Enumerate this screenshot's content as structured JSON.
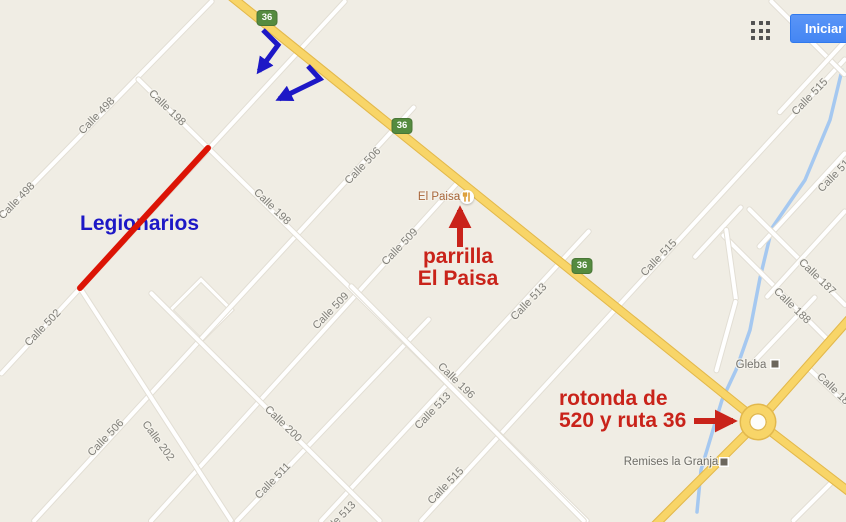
{
  "ui": {
    "signin_label": "Iniciar",
    "apps_icon": "grid-3x3-icon",
    "signin_color": "#4486f3"
  },
  "map": {
    "bg_color": "#f0ede4",
    "road_color": "#ffffff",
    "highway_color": "#f8d568",
    "river_color": "#a5c8f0",
    "label_color": "#807f79",
    "road_shields": [
      {
        "text": "36",
        "x": 267,
        "y": 18
      },
      {
        "text": "36",
        "x": 402,
        "y": 126
      },
      {
        "text": "36",
        "x": 582,
        "y": 266
      }
    ],
    "roads": [
      {
        "name": "calle-498",
        "type": "minor",
        "x1": 213,
        "y1": 0,
        "x2": 0,
        "y2": 218
      },
      {
        "name": "calle-502-legionarios",
        "type": "minor",
        "x1": 346,
        "y1": 0,
        "x2": 0,
        "y2": 375
      },
      {
        "name": "calle-506",
        "type": "minor",
        "x1": 415,
        "y1": 106,
        "x2": 33,
        "y2": 522
      },
      {
        "name": "calle-509",
        "type": "minor",
        "x1": 460,
        "y1": 180,
        "x2": 150,
        "y2": 522
      },
      {
        "name": "calle-511",
        "type": "minor",
        "x1": 430,
        "y1": 318,
        "x2": 236,
        "y2": 522
      },
      {
        "name": "calle-513",
        "type": "minor",
        "x1": 590,
        "y1": 230,
        "x2": 320,
        "y2": 522
      },
      {
        "name": "calle-515",
        "type": "minor",
        "x1": 846,
        "y1": 58,
        "x2": 420,
        "y2": 522
      },
      {
        "name": "calle-517",
        "type": "minor",
        "x1": 846,
        "y1": 152,
        "x2": 758,
        "y2": 248
      },
      {
        "name": "calle-198",
        "type": "minor",
        "x1": 137,
        "y1": 78,
        "x2": 588,
        "y2": 522
      },
      {
        "name": "calle-200",
        "type": "minor",
        "x1": 150,
        "y1": 292,
        "x2": 381,
        "y2": 522
      },
      {
        "name": "calle-202",
        "type": "minor",
        "x1": 80,
        "y1": 288,
        "x2": 232,
        "y2": 522
      },
      {
        "name": "calle-196",
        "type": "minor",
        "x1": 350,
        "y1": 285,
        "x2": 585,
        "y2": 522
      },
      {
        "name": "road-ne-1",
        "type": "minor",
        "x1": 770,
        "y1": 0,
        "x2": 846,
        "y2": 76
      },
      {
        "name": "road-ne-2",
        "type": "minor",
        "x1": 846,
        "y1": 40,
        "x2": 778,
        "y2": 114
      },
      {
        "name": "calle-187",
        "type": "minor",
        "x1": 748,
        "y1": 208,
        "x2": 846,
        "y2": 306
      },
      {
        "name": "calle-188",
        "type": "minor",
        "x1": 722,
        "y1": 234,
        "x2": 830,
        "y2": 342
      },
      {
        "name": "gleba-grid-1",
        "type": "minor",
        "x1": 742,
        "y1": 206,
        "x2": 694,
        "y2": 258
      },
      {
        "name": "gleba-grid-2",
        "type": "minor",
        "x1": 846,
        "y1": 210,
        "x2": 766,
        "y2": 298
      },
      {
        "name": "gleba-grid-3",
        "type": "minor",
        "x1": 816,
        "y1": 296,
        "x2": 748,
        "y2": 368
      },
      {
        "name": "gleba-grid-4",
        "type": "minor",
        "x1": 726,
        "y1": 228,
        "x2": 736,
        "y2": 300
      },
      {
        "name": "gleba-grid-5",
        "type": "minor",
        "x1": 736,
        "y1": 300,
        "x2": 716,
        "y2": 372
      },
      {
        "name": "calle-18x",
        "type": "minor",
        "x1": 806,
        "y1": 366,
        "x2": 846,
        "y2": 404
      },
      {
        "name": "road-se-corner",
        "type": "minor",
        "x1": 836,
        "y1": 478,
        "x2": 792,
        "y2": 522
      },
      {
        "name": "ruta-36-nw",
        "type": "hwy",
        "x1": 228,
        "y1": -6,
        "x2": 760,
        "y2": 423
      },
      {
        "name": "ruta-36-se",
        "type": "hwy",
        "x1": 757,
        "y1": 421,
        "x2": 852,
        "y2": 494
      },
      {
        "name": "ruta-520-ne",
        "type": "hwy",
        "x1": 850,
        "y1": 318,
        "x2": 758,
        "y2": 422
      },
      {
        "name": "ruta-520-sw",
        "type": "hwy",
        "x1": 758,
        "y1": 422,
        "x2": 650,
        "y2": 530
      }
    ],
    "street_labels": [
      {
        "text": "Calle 498",
        "x": 97,
        "y": 116,
        "r": -46
      },
      {
        "text": "Calle 498",
        "x": 17,
        "y": 201,
        "r": -46
      },
      {
        "text": "Calle 502",
        "x": 43,
        "y": 328,
        "r": -46
      },
      {
        "text": "Calle 506",
        "x": 363,
        "y": 166,
        "r": -46
      },
      {
        "text": "Calle 506",
        "x": 106,
        "y": 438,
        "r": -46
      },
      {
        "text": "Calle 509",
        "x": 400,
        "y": 247,
        "r": -46
      },
      {
        "text": "Calle 509",
        "x": 331,
        "y": 311,
        "r": -46
      },
      {
        "text": "Calle 511",
        "x": 273,
        "y": 481,
        "r": -46
      },
      {
        "text": "Calle 513",
        "x": 529,
        "y": 302,
        "r": -46
      },
      {
        "text": "Calle 513",
        "x": 433,
        "y": 411,
        "r": -46
      },
      {
        "text": "Calle 513",
        "x": 338,
        "y": 520,
        "r": -46
      },
      {
        "text": "Calle 515",
        "x": 446,
        "y": 486,
        "r": -46
      },
      {
        "text": "Calle 515",
        "x": 659,
        "y": 258,
        "r": -46
      },
      {
        "text": "Calle 515",
        "x": 810,
        "y": 97,
        "r": -46
      },
      {
        "text": "Calle 51",
        "x": 834,
        "y": 176,
        "r": -46
      },
      {
        "text": "Calle 198",
        "x": 167,
        "y": 108,
        "r": 44
      },
      {
        "text": "Calle 198",
        "x": 272,
        "y": 207,
        "r": 44
      },
      {
        "text": "Calle 200",
        "x": 283,
        "y": 424,
        "r": 44
      },
      {
        "text": "Calle 202",
        "x": 158,
        "y": 441,
        "r": 54
      },
      {
        "text": "Calle 196",
        "x": 456,
        "y": 381,
        "r": 44
      },
      {
        "text": "Calle 187",
        "x": 817,
        "y": 277,
        "r": 44
      },
      {
        "text": "Calle 188",
        "x": 792,
        "y": 306,
        "r": 44
      },
      {
        "text": "Calle 18",
        "x": 833,
        "y": 389,
        "r": 44
      }
    ],
    "river": {
      "points": "842,70 830,120 805,180 772,228 760,278 750,330 736,370 722,400 710,440 701,470 697,512"
    },
    "roundabout": {
      "x": 758,
      "y": 422
    },
    "diamond_loop": {
      "x": 201,
      "y": 310
    },
    "pois": [
      {
        "name": "el-paisa",
        "label": "El Paisa",
        "color": "#a8663a",
        "x": 439,
        "y": 197,
        "icon": "restaurant-icon",
        "icon_x": 467,
        "icon_y": 197
      },
      {
        "name": "gleba",
        "label": "Gleba",
        "color": "#76746e",
        "x": 751,
        "y": 365,
        "marker": "#6c675e",
        "marker_x": 775,
        "marker_y": 364
      },
      {
        "name": "remises-la-granja",
        "label": "Remises la Granja",
        "color": "#6d6c66",
        "x": 671,
        "y": 462,
        "marker": "#6c675e",
        "marker_x": 724,
        "marker_y": 462
      }
    ]
  },
  "annotations": {
    "blue_color": "#1d18c6",
    "red_color": "#c9231a",
    "red_line_color": "#dc1405",
    "legionarios": {
      "text": "Legionarios"
    },
    "parrilla": {
      "line1": "parrilla",
      "line2": "El Paisa"
    },
    "rotonda": {
      "line1": "rotonda de",
      "line2": "520 y ruta 36"
    },
    "red_line": {
      "x1": 208,
      "y1": 148,
      "x2": 80,
      "y2": 288
    },
    "red_arrows": [
      {
        "name": "arrow-to-el-paisa",
        "x1": 460,
        "y1": 247,
        "x2": 460,
        "y2": 210
      },
      {
        "name": "arrow-to-rotonda",
        "x1": 694,
        "y1": 421,
        "x2": 733,
        "y2": 421
      }
    ],
    "blue_arrows": [
      {
        "name": "turn-arrow-1",
        "points": "263,30 278,45 259,71"
      },
      {
        "name": "turn-arrow-2",
        "points": "308,66 320,79 279,99"
      }
    ]
  }
}
